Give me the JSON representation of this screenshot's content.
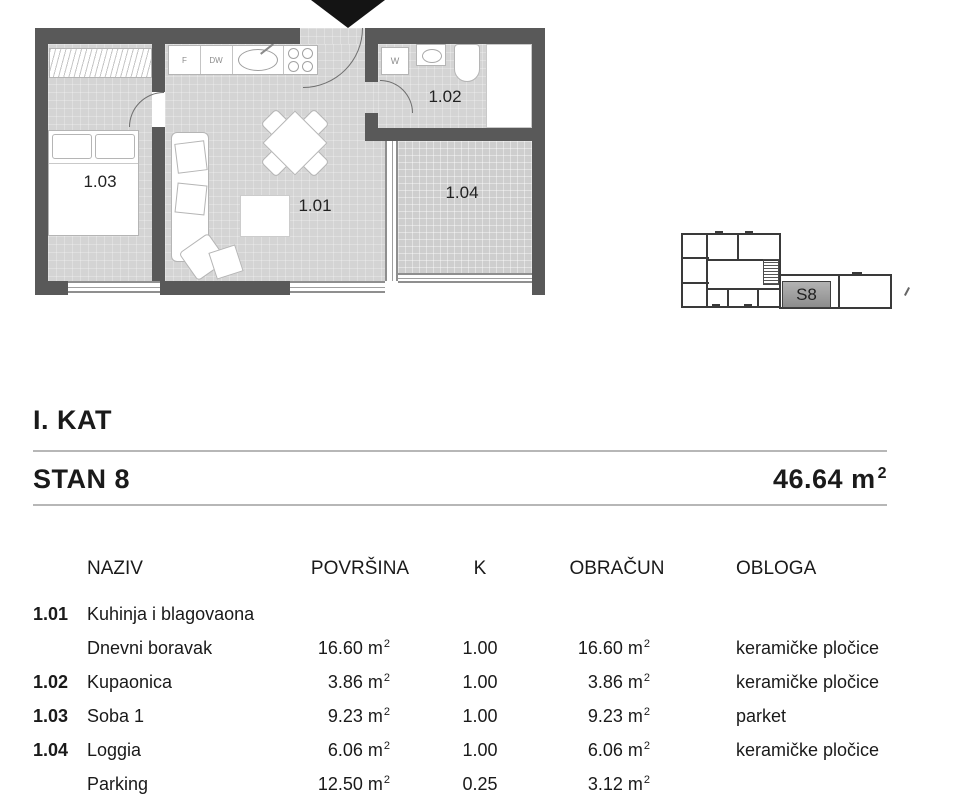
{
  "headings": {
    "floor_label": "I. KAT",
    "unit_label": "STAN 8",
    "total_area_value": "46.64",
    "total_area_unit_base": "m",
    "total_area_unit_sup": "2"
  },
  "floor_plan": {
    "rooms": [
      {
        "label": "1.01"
      },
      {
        "label": "1.02"
      },
      {
        "label": "1.03"
      },
      {
        "label": "1.04"
      }
    ],
    "appliances": {
      "fridge_label": "F",
      "dishwasher_label": "DW",
      "washer_label": "W"
    }
  },
  "mini_plan": {
    "unit_badge": "S8"
  },
  "table": {
    "headers": [
      "NAZIV",
      "POVRŠINA",
      "K",
      "OBRAČUN",
      "OBLOGA"
    ],
    "unit_base": "m",
    "unit_sup": "2",
    "rows": [
      {
        "code": "1.01",
        "naziv": "Kuhinja i blagovaona",
        "povrsina": "",
        "k": "",
        "obracun": "",
        "obloga": ""
      },
      {
        "code": "",
        "naziv": "Dnevni boravak",
        "povrsina": "16.60",
        "k": "1.00",
        "obracun": "16.60",
        "obloga": "keramičke pločice"
      },
      {
        "code": "1.02",
        "naziv": "Kupaonica",
        "povrsina": "3.86",
        "k": "1.00",
        "obracun": "3.86",
        "obloga": "keramičke pločice"
      },
      {
        "code": "1.03",
        "naziv": "Soba 1",
        "povrsina": "9.23",
        "k": "1.00",
        "obracun": "9.23",
        "obloga": "parket"
      },
      {
        "code": "1.04",
        "naziv": "Loggia",
        "povrsina": "6.06",
        "k": "1.00",
        "obracun": "6.06",
        "obloga": "keramičke pločice"
      },
      {
        "code": "",
        "naziv": "Parking",
        "povrsina": "12.50",
        "k": "0.25",
        "obracun": "3.12",
        "obloga": ""
      }
    ]
  },
  "colors": {
    "wall": "#595959",
    "floor": "#d4d4d4",
    "badge_fill": "#9e9e9e",
    "rule": "#b7b7b7"
  }
}
